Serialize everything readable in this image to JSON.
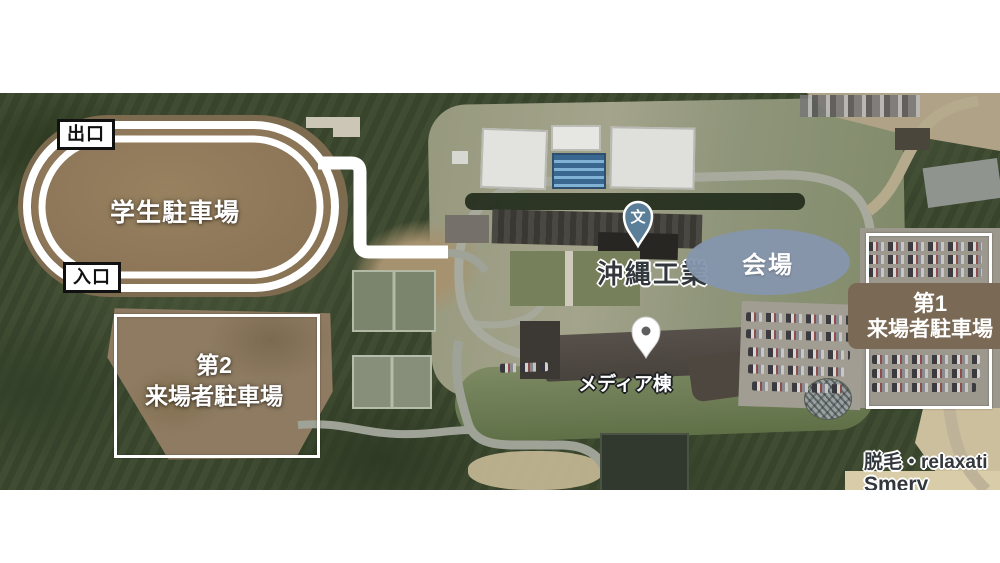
{
  "overlay": {
    "exit": "出口",
    "entrance": "入口",
    "student_parking": "学生駐車場",
    "visitor2": {
      "line1": "第2",
      "line2": "来場者駐車場"
    },
    "visitor1": {
      "line1": "第1",
      "line2": "来場者駐車場"
    },
    "venue": "会場",
    "school_pin": "文",
    "school_name": "沖縄工業",
    "media": "メディア棟",
    "poi": {
      "line1": "脱毛・relaxati",
      "line2": "Smery"
    },
    "colors": {
      "route": "#ffffff",
      "venue_ellipse": "#8696ad",
      "school_pin": "#5b7e99",
      "visitor1_box": "#7a6954",
      "label_box_border": "#111111"
    }
  }
}
